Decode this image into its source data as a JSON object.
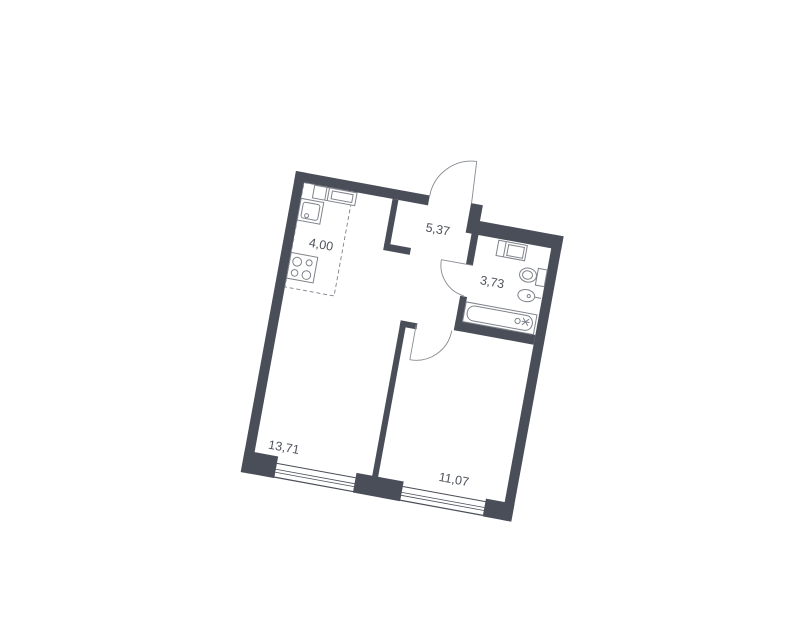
{
  "page": {
    "background_color": "#ffffff",
    "description": "Apartment floor plan drawing, rotated slightly clockwise"
  },
  "floorplan": {
    "rotation_deg": 10.4,
    "colors": {
      "wall": "#4a4e58",
      "fixture_line": "#7e828a",
      "door_line": "#878b92",
      "label_text": "#4e525b",
      "floor": "#ffffff"
    },
    "rooms": [
      {
        "id": "kitchen-zone",
        "area_label": "4,00"
      },
      {
        "id": "hallway",
        "area_label": "5,37"
      },
      {
        "id": "bathroom",
        "area_label": "3,73"
      },
      {
        "id": "living-room",
        "area_label": "13,71"
      },
      {
        "id": "bedroom",
        "area_label": "11,07"
      }
    ],
    "features": {
      "doors": [
        "entrance-door",
        "bathroom-door",
        "bedroom-door"
      ],
      "windows_count": 2,
      "kitchen_fixtures": [
        "counter-unit",
        "kitchen-sink",
        "stove"
      ],
      "bathroom_fixtures": [
        "washing-machine",
        "toilet",
        "bathroom-sink",
        "bathtub"
      ]
    }
  }
}
